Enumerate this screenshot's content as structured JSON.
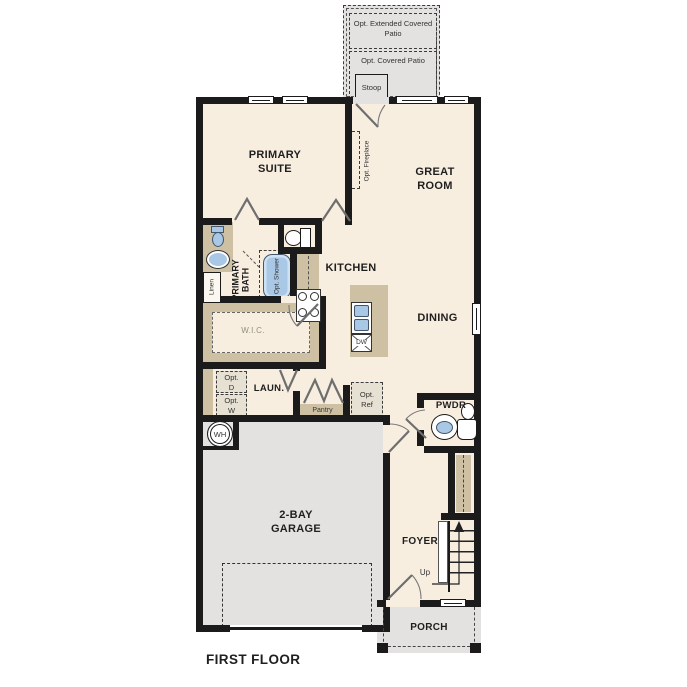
{
  "plan": {
    "title": "FIRST FLOOR",
    "rooms": {
      "primary_suite": "PRIMARY SUITE",
      "great_room": "GREAT ROOM",
      "kitchen": "KITCHEN",
      "dining": "DINING",
      "primary_bath": "PRIMARY BATH",
      "wic": "W.I.C.",
      "laundry": "LAUN.",
      "pantry": "Pantry",
      "pwdr": "PWDR",
      "garage": "2-BAY GARAGE",
      "foyer": "FOYER",
      "porch": "PORCH"
    },
    "outdoor": {
      "extended_patio": "Opt. Extended Covered Patio",
      "covered_patio": "Opt. Covered Patio",
      "stoop": "Stoop"
    },
    "options": {
      "fireplace": "Opt. Fireplace",
      "shower": "Opt. Shower",
      "dryer": "Opt. D",
      "washer": "Opt. W",
      "refrigerator": "Opt. Ref"
    },
    "fixtures": {
      "linen": "Linen",
      "water_heater": "WH",
      "dishwasher": "DW",
      "stairs_up": "Up"
    },
    "colors": {
      "wall": "#1b1b1b",
      "floor": "#f8eee0",
      "concrete": "#e3e2e0",
      "cabinet": "#cec0a3",
      "fixture_blue": "#a9c8e6"
    }
  }
}
